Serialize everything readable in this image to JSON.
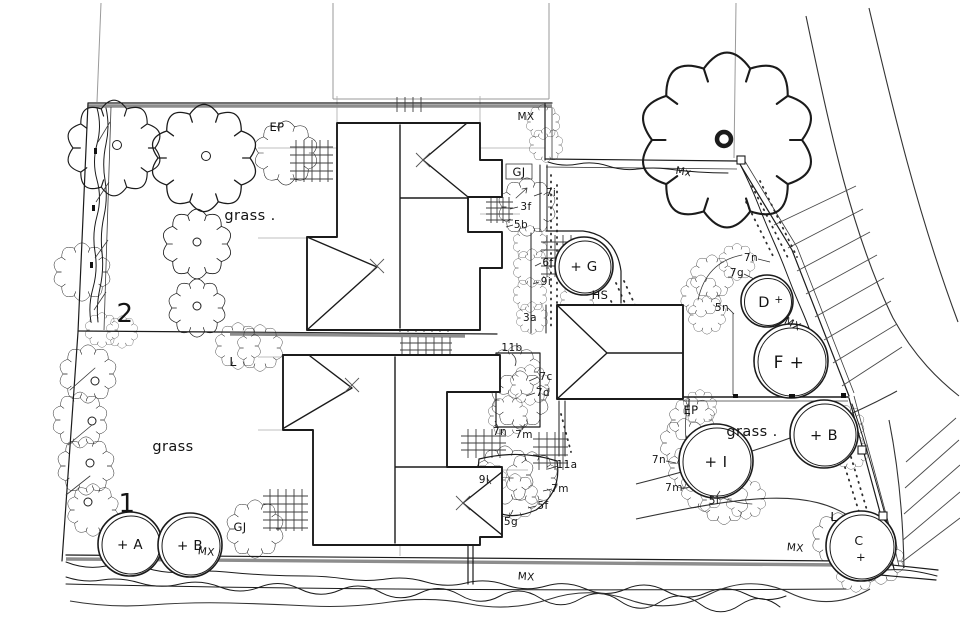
{
  "colors": {
    "ink": "#1b1b1b",
    "pencil": "#9a9a9a",
    "paper": "#ffffff"
  },
  "plot_numbers": {
    "plot1": "1",
    "plot2": "2"
  },
  "area_labels": {
    "grass_plot2": "grass .",
    "grass_plot1": "grass",
    "grass_right": "grass ."
  },
  "feature_labels": {
    "ep_top": "EP",
    "ep_right": "EP",
    "hs": "HS",
    "gj_top": "GJ",
    "gj_bottom": "GJ",
    "l_left": "L",
    "l_right": "L",
    "mx_top": "MX",
    "mx_tree": "Mx",
    "mx_band": "MX",
    "mx_bottom_left": "MX",
    "mx_bottom_mid": "MX",
    "mx_bottom_right": "MX"
  },
  "planting_labels": {
    "p7i": "7i",
    "p3f": "3f",
    "p5b": "5b",
    "p6f": "6f",
    "p9i": "9i",
    "p3a": "3a",
    "p11b": "11b",
    "p7c": "7c",
    "p7d": "7d",
    "p7n_mid": "7n",
    "p7m_mid": "7m",
    "p11a": "11a",
    "p9l": "9l",
    "p7m_low": "7m",
    "p5f": "5f",
    "p5g": "5g",
    "p7n_d": "7n",
    "p7g": "7g",
    "p5n": "5n",
    "p7n_i": "7n",
    "p7m_i": "7m",
    "p5i": "5i"
  },
  "tree_circle_labels": {
    "a": "+ A",
    "b1": "+ B",
    "g": "+ G",
    "d": "D",
    "d_plus": "+",
    "f": "F +",
    "b2": "+ B",
    "i": "+ I",
    "c": "C",
    "c_plus": "+"
  }
}
